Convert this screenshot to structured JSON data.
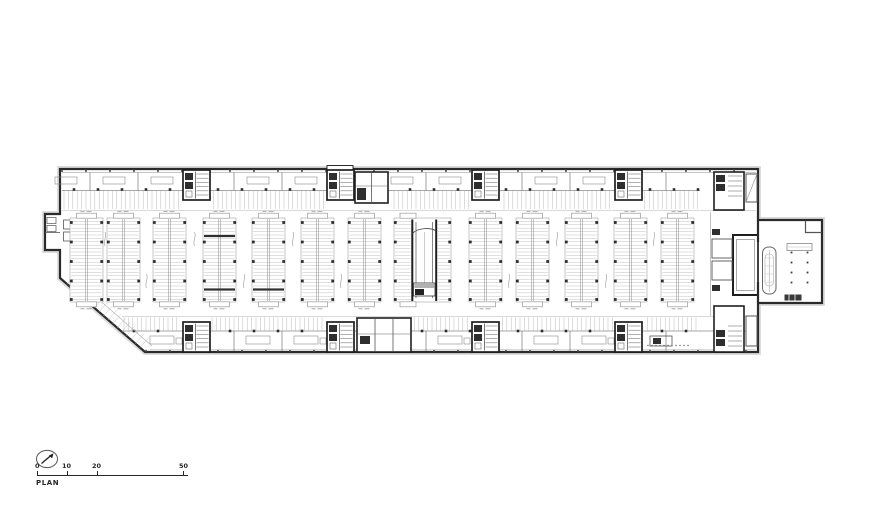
{
  "annotation": {
    "plan_label": "PLAN",
    "scale_bar": {
      "labels": [
        "0",
        "10",
        "20",
        "50"
      ]
    },
    "north_arrow_icon": "compass-needle-pointing-northeast"
  },
  "plan": {
    "type": "parking-garage-floor-plan",
    "colors": {
      "wall": "#2a2a2a",
      "ink": "#1f1f1f",
      "mid": "#8a8a8a",
      "part": "#6f6f6f",
      "hatch": "#b9b9b9",
      "light": "#c6c6c6",
      "dark": "#2e2e2e",
      "halo": "#dcdcdc"
    },
    "outline": "M60,169 L758,169 L758,220 L822,220 L822,303 L758,303 L758,352 L145,352 L60,278 L60,250 L45,250 L45,214 L60,214 Z",
    "top_band": {
      "wall_y": 169,
      "inner_y": 172.5,
      "head_y": 190.5,
      "aisle_y": 210.7,
      "x0": 62,
      "x1": 756,
      "cores_x": [
        183,
        327,
        472,
        615
      ],
      "skips": [
        [
          181,
          212
        ],
        [
          325,
          391
        ],
        [
          470,
          501
        ],
        [
          613,
          644
        ],
        [
          700,
          758
        ]
      ],
      "block": {
        "x": 355,
        "y": 172,
        "w": 33,
        "h": 31
      }
    },
    "bottom_band": {
      "aisle_y": 316.3,
      "head_y": 331,
      "x0": 122,
      "x1": 756,
      "cores_x": [
        183,
        327,
        472,
        615
      ],
      "skips": [
        [
          181,
          212
        ],
        [
          325,
          413
        ],
        [
          470,
          501
        ],
        [
          613,
          644
        ],
        [
          700,
          758
        ]
      ],
      "block": {
        "x": 357,
        "y": 318,
        "w": 54,
        "h": 34
      }
    },
    "islands": {
      "lefts": [
        70,
        107,
        153,
        203,
        252,
        301,
        348,
        469,
        516,
        565,
        614,
        661
      ],
      "width": 33,
      "top": 218,
      "bottom": 302,
      "column_rows": [
        222.5,
        242,
        261.5,
        281,
        299.5
      ],
      "hatch_step": 3.4,
      "dark_bars": {
        "3": [
          236,
          289.5
        ],
        "4": [
          289.5
        ]
      }
    },
    "ramp": {
      "x": 394,
      "w": 57,
      "wall1": 412.3,
      "wall2": 436.2
    },
    "chamfer": {
      "p1": [
        62,
        280
      ],
      "p2": [
        145,
        352
      ]
    },
    "right_section": {
      "hall": [
        733,
        235,
        25,
        60
      ]
    },
    "wing": {
      "x": 758,
      "y": 220,
      "w": 64,
      "h": 83,
      "dot_cols": [
        791.5,
        807.5
      ],
      "dot_rows": [
        252.5,
        262.5,
        272.5,
        282.5
      ]
    }
  }
}
